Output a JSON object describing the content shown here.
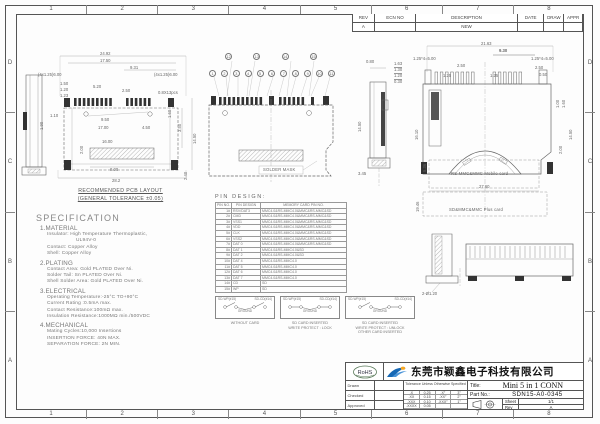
{
  "sheet": {
    "zones_top": [
      "1",
      "2",
      "3",
      "4",
      "5",
      "6",
      "7",
      "8"
    ],
    "zones_bottom": [
      "1",
      "2",
      "3",
      "4",
      "5",
      "6",
      "7",
      "8"
    ],
    "zones_left": [
      "D",
      "C",
      "B",
      "A"
    ],
    "zones_right": [
      "D",
      "C",
      "B",
      "A"
    ]
  },
  "rev_table": {
    "headers": [
      "REV",
      "ECN NO",
      "DESCRIPTION",
      "DATE",
      "DRAW",
      "APPR"
    ],
    "row": [
      "A",
      "",
      "NEW",
      "",
      "",
      ""
    ]
  },
  "pcb": {
    "caption1": "RECOMMENDED PCB LAYOUT",
    "caption2": "(GENERAL TOLERANCE ±0.05)",
    "dims": [
      "24.92",
      "17.50",
      "9.31",
      "(4x1.25)6.00",
      "(4x1.25)6.00",
      "1.50",
      "1.20",
      "1.23",
      "5.20",
      "2.50",
      "0.8X13pcs",
      "1.10",
      "1.90",
      "9.50",
      "17.00",
      "4.50",
      "16.00",
      "2.00",
      "8.00",
      "28.2",
      "2.40",
      "14.50",
      "3.50",
      "1.60"
    ]
  },
  "topview": {
    "balloons_top": [
      "12",
      "13",
      "14",
      "15"
    ],
    "balloons_bottom": [
      "1",
      "2",
      "3",
      "4",
      "5",
      "6",
      "7",
      "8",
      "9",
      "10",
      "11"
    ],
    "mask_label": "SOLDER MASK"
  },
  "sideview": {
    "dims": [
      "0.80",
      "14.50",
      "3.45"
    ],
    "stack": [
      "1.63",
      "1.30",
      "1.20",
      "0.30"
    ]
  },
  "rightview": {
    "card1": "RS-MMC&MMC Mobile card",
    "card2": "SD&MMC&MMC Plus card",
    "dims": [
      "21.63",
      "9.30",
      "1.25*4=5.00",
      "1.25*4=5.00",
      "2.50",
      "2.50",
      "0.50",
      "1.25",
      "1.25",
      "16.10",
      "14.50",
      "1.00",
      "1.60",
      "2.00",
      "5.36",
      "27.60",
      "19.46"
    ]
  },
  "bottomview": {
    "dims": [
      "2-Ø1.20"
    ]
  },
  "pin_table": {
    "title": "PIN DESIGN:",
    "headers": [
      "PIN NO.",
      "PIN DESIGN",
      "MEMORY CARD PIN NO."
    ],
    "rows": [
      [
        "1#",
        "RSV/DAT3",
        "MMC4.0&RS-MMC4.0&MMC&RS-MMC&SD"
      ],
      [
        "2#",
        "CMD",
        "MMC4.0&RS-MMC4.0&MMC&RS-MMC&SD"
      ],
      [
        "3#",
        "VSS1",
        "MMC4.0&RS-MMC4.0&MMC&RS-MMC&SD"
      ],
      [
        "4#",
        "VDD",
        "MMC4.0&RS-MMC4.0&MMC&RS-MMC&SD"
      ],
      [
        "5#",
        "CLK",
        "MMC4.0&RS-MMC4.0&MMC&RS-MMC&SD"
      ],
      [
        "6#",
        "VSS2",
        "MMC4.0&RS-MMC4.0&MMC&RS-MMC&SD"
      ],
      [
        "7#",
        "DAT 0",
        "MMC4.0&RS-MMC4.0&MMC&RS-MMC&SD"
      ],
      [
        "8#",
        "DAT 1",
        "MMC4.0&RS-MMC4.0&SD"
      ],
      [
        "9#",
        "DAT 2",
        "MMC4.0&RS-MMC4.0&SD"
      ],
      [
        "10#",
        "DAT 4",
        "MMC4.0&RS-MMC4.0"
      ],
      [
        "11#",
        "DAT 5",
        "MMC4.0&RS-MMC4.0"
      ],
      [
        "12#",
        "DAT 6",
        "MMC4.0&RS-MMC4.0"
      ],
      [
        "13#",
        "DAT 7",
        "MMC4.0&RS-MMC4.0"
      ],
      [
        "14#",
        "CD",
        "SD"
      ],
      [
        "15#",
        "WP",
        "SD"
      ]
    ]
  },
  "spec": {
    "lines": [
      "SPECIFICATION",
      "1.MATERIAL",
      "Insulator: High Temperature Thermoplastic,",
      "UL94V-0",
      "Contact: Copper Alloy",
      "Shell: Copper Alloy",
      "2.PLATING",
      "Contact Area: Gold PLATED Over Ni.",
      "Solder Tail:  Sn PLATED Over Ni.",
      "Shell Solder Area: Gold PLATED Over Ni.",
      "3.ELECTRICAL",
      "Operating Temperature:-25°C TO+90°C",
      "Current Rating :0.5mA max.",
      "Contact Resistance:100mΩ max.",
      "Insulation Resistance:1000MΩ min./500VDC",
      "4.MECHANICAL",
      "Mating Cycles:10,000 Insertions",
      "INSERTION FORCE: 40N MAX.",
      "SEPARATION FORCE: 2N MIN."
    ]
  },
  "switches": {
    "wp_label": "SD-WP(#15)",
    "cd_label": "SD-CD(#14)",
    "ground": "GROUND",
    "cap1": [
      "WITHOUT CARD"
    ],
    "cap2": [
      "SD CARD INSERTED",
      "WRITE PROTECT : LOCK"
    ],
    "cap3": [
      "SD CARD INSERTED",
      "WRITE PROTECT : UNLOCK",
      "OTHER CARD INSERTED"
    ]
  },
  "title_block": {
    "rohs": "RoHS",
    "company": "东莞市颖鑫电子科技有限公司",
    "sign_rows": [
      "Drawn",
      "Checked",
      "Approved"
    ],
    "tol_header": "Tolerance Unless Otherwise Specified",
    "tol": [
      [
        ".X",
        "0.25",
        ".X°",
        "3°"
      ],
      [
        ".XX",
        "0.15",
        ".XX°",
        "2°"
      ],
      [
        ".XXX",
        "0.10",
        ".XXX°",
        "1°"
      ],
      [
        ".XXXX",
        "0.05",
        "",
        ""
      ]
    ],
    "title_label": "Title:",
    "title_value": "Mini 5 in 1 CONN",
    "part_label": "Part No.:",
    "part_value": "SDN15-A0-0345",
    "sheet_label": "Sheet",
    "sheet_value": "1/1",
    "rev_label": "Rev",
    "rev_value": "A"
  }
}
